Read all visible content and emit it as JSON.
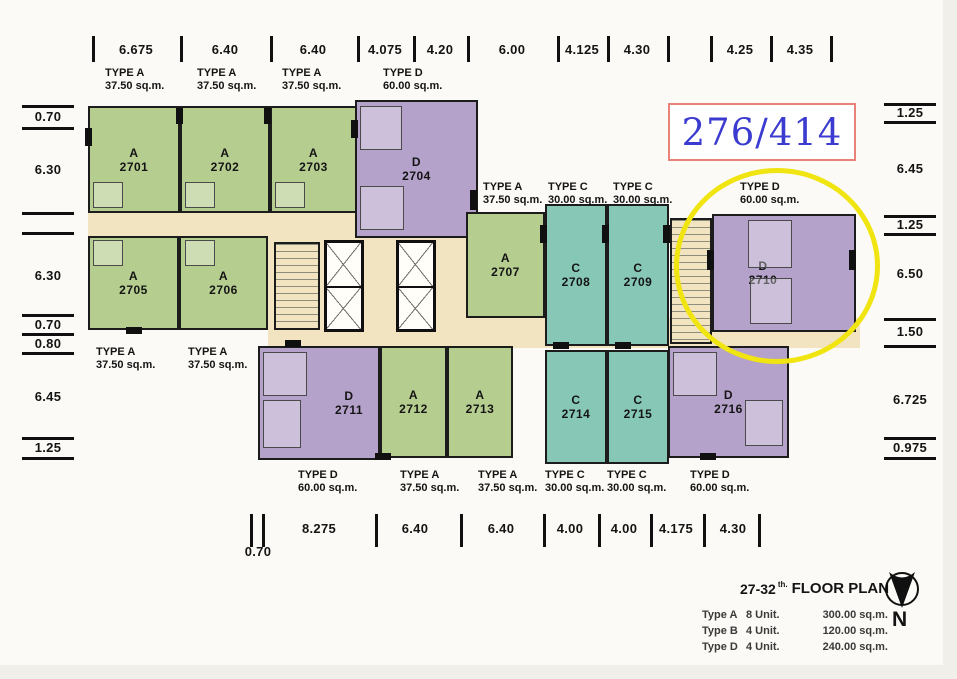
{
  "highlight": {
    "ref": "276/414"
  },
  "dims": {
    "top": [
      "6.675",
      "6.40",
      "6.40",
      "4.075",
      "4.20",
      "6.00",
      "4.125",
      "4.30",
      "4.25",
      "4.35"
    ],
    "bottom": [
      "0.70",
      "8.275",
      "6.40",
      "6.40",
      "4.00",
      "4.00",
      "4.175",
      "4.30"
    ],
    "left": [
      "0.70",
      "6.30",
      "6.30",
      "0.70",
      "0.80",
      "6.45",
      "1.25"
    ],
    "right": [
      "1.25",
      "6.45",
      "1.25",
      "6.50",
      "1.50",
      "6.725",
      "0.975"
    ]
  },
  "type_labels": {
    "top": [
      {
        "t": "TYPE A",
        "a": "37.50 sq.m."
      },
      {
        "t": "TYPE A",
        "a": "37.50 sq.m."
      },
      {
        "t": "TYPE A",
        "a": "37.50 sq.m."
      },
      {
        "t": "TYPE D",
        "a": "60.00 sq.m."
      }
    ],
    "middle": [
      {
        "t": "TYPE A",
        "a": "37.50 sq.m."
      },
      {
        "t": "TYPE C",
        "a": "30.00 sq.m."
      },
      {
        "t": "TYPE C",
        "a": "30.00 sq.m."
      },
      {
        "t": "TYPE D",
        "a": "60.00 sq.m."
      }
    ],
    "left_mid": [
      {
        "t": "TYPE A",
        "a": "37.50 sq.m."
      },
      {
        "t": "TYPE A",
        "a": "37.50 sq.m."
      }
    ],
    "bottom": [
      {
        "t": "TYPE D",
        "a": "60.00 sq.m."
      },
      {
        "t": "TYPE A",
        "a": "37.50 sq.m."
      },
      {
        "t": "TYPE A",
        "a": "37.50 sq.m."
      },
      {
        "t": "TYPE C",
        "a": "30.00 sq.m."
      },
      {
        "t": "TYPE C",
        "a": "30.00 sq.m."
      },
      {
        "t": "TYPE D",
        "a": "60.00 sq.m."
      }
    ]
  },
  "units": {
    "2701": {
      "letter": "A",
      "number": "2701"
    },
    "2702": {
      "letter": "A",
      "number": "2702"
    },
    "2703": {
      "letter": "A",
      "number": "2703"
    },
    "2704": {
      "letter": "D",
      "number": "2704"
    },
    "2705": {
      "letter": "A",
      "number": "2705"
    },
    "2706": {
      "letter": "A",
      "number": "2706"
    },
    "2707": {
      "letter": "A",
      "number": "2707"
    },
    "2708": {
      "letter": "C",
      "number": "2708"
    },
    "2709": {
      "letter": "C",
      "number": "2709"
    },
    "2710": {
      "letter": "D",
      "number": "2710"
    },
    "2711": {
      "letter": "D",
      "number": "2711"
    },
    "2712": {
      "letter": "A",
      "number": "2712"
    },
    "2713": {
      "letter": "A",
      "number": "2713"
    },
    "2714": {
      "letter": "C",
      "number": "2714"
    },
    "2715": {
      "letter": "C",
      "number": "2715"
    },
    "2716": {
      "letter": "D",
      "number": "2716"
    }
  },
  "legend": {
    "floors": "27-32",
    "ordinal": "th.",
    "title": "FLOOR PLAN",
    "north": "N",
    "rows": [
      {
        "type": "Type A",
        "count": "8 Unit.",
        "area": "300.00 sq.m."
      },
      {
        "type": "Type B",
        "count": "4 Unit.",
        "area": "120.00 sq.m."
      },
      {
        "type": "Type D",
        "count": "4 Unit.",
        "area": "240.00 sq.m."
      }
    ]
  },
  "colors": {
    "type_a": "#b6cd90",
    "type_c": "#87c7b6",
    "type_d": "#b4a2ca",
    "corridor": "#f2e3c1",
    "wall": "#1c1c1c",
    "highlight_ring": "#f0e411",
    "ref_text": "#3b3bd0",
    "ref_border": "#e8837a"
  }
}
